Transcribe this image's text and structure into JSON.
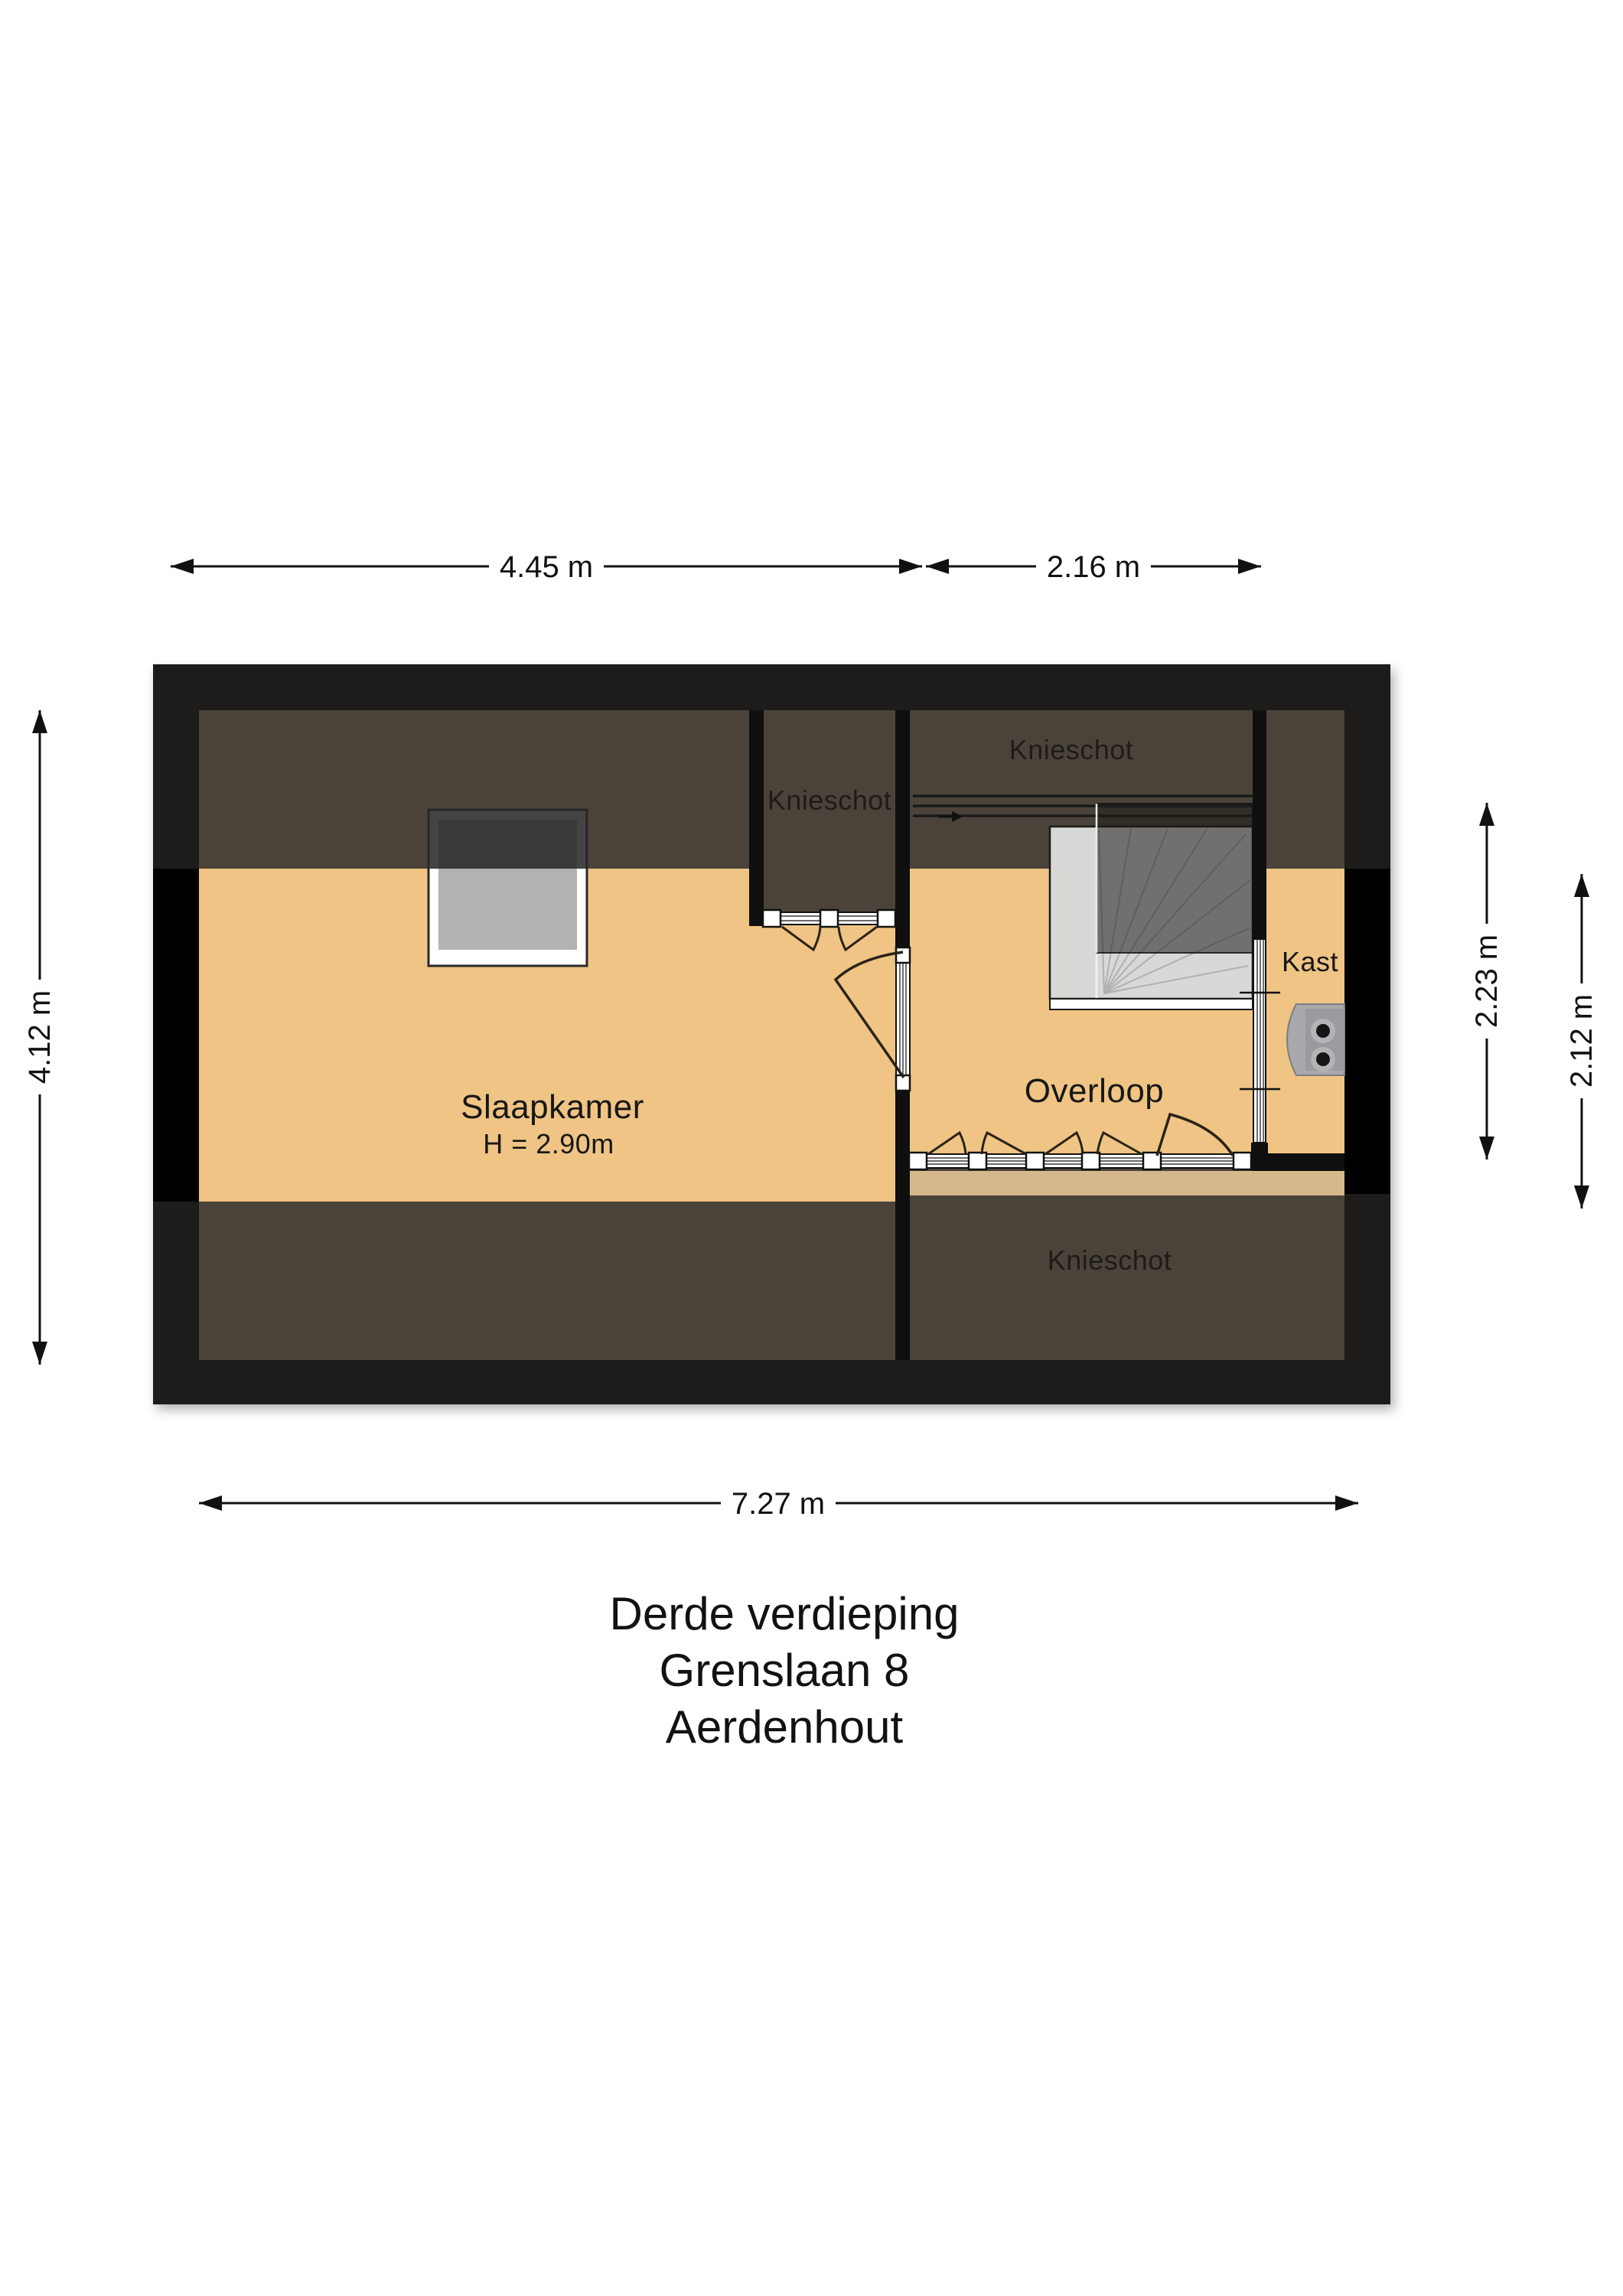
{
  "plan": {
    "name": "floor-plan",
    "rooms": {
      "slaapkamer": {
        "label": "Slaapkamer",
        "height_note": "H = 2.90m"
      },
      "overloop": {
        "label": "Overloop"
      },
      "kast": {
        "label": "Kast"
      },
      "knieschot_top": {
        "label": "Knieschot"
      },
      "knieschot_middle": {
        "label": "Knieschot"
      },
      "knieschot_bottom": {
        "label": "Knieschot"
      }
    },
    "icons": {
      "boiler": "mechanical-unit-icon",
      "stairs": "stairs-icon",
      "direction_arrow": "right-arrow-icon"
    }
  },
  "dimensions": {
    "top_left": "4.45 m",
    "top_right": "2.16 m",
    "bottom": "7.27 m",
    "left": "4.12 m",
    "right_inner": "2.23 m",
    "right_outer": "2.12 m"
  },
  "title": {
    "line1": "Derde verdieping",
    "line2": "Grenslaan 8",
    "line3": "Aerdenhout"
  },
  "colors": {
    "floor_orange": "#efc484",
    "floor_tan": "#d5b98d",
    "knieschot_brown": "#4b4339",
    "outer_band": "#1d1c1b",
    "wall_black": "#0f0f0f",
    "stair_gray": "#d8d8d6",
    "boiler_gray": "#a9a9ac"
  }
}
